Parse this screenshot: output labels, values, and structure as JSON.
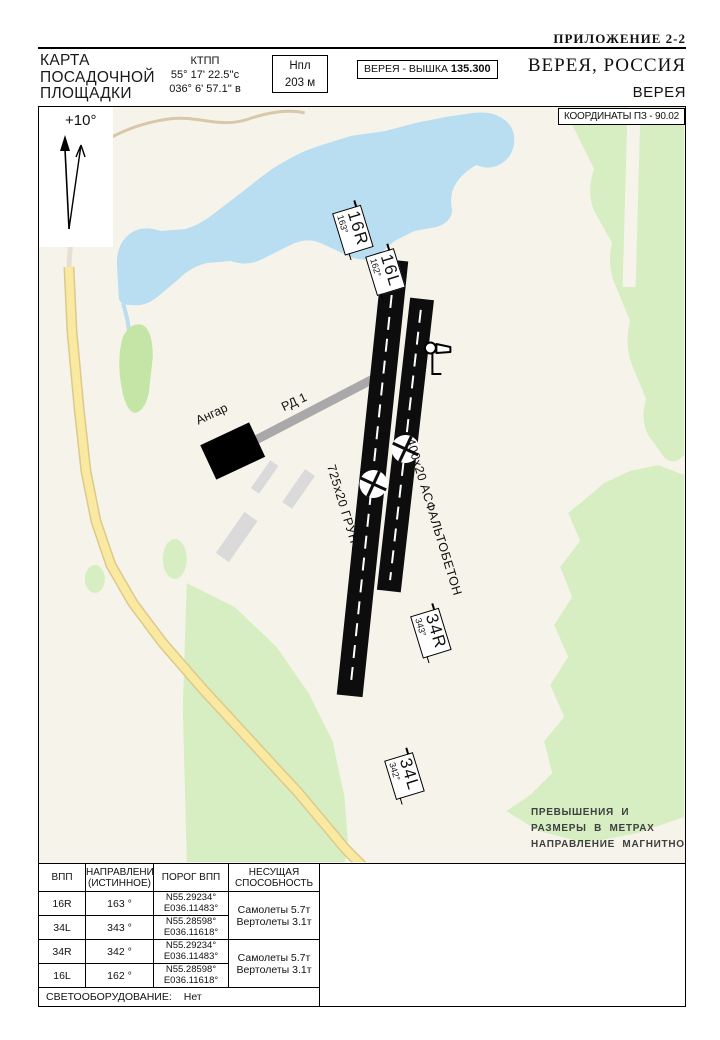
{
  "page": {
    "appendix": "ПРИЛОЖЕНИЕ  2-2",
    "title_city": "ВЕРЕЯ, РОССИЯ",
    "title_site": "ВЕРЕЯ",
    "chart_type": {
      "l1": "КАРТА",
      "l2": "ПОСАДОЧНОЙ",
      "l3": "ПЛОЩАДКИ"
    },
    "ktpp": {
      "label": "КТПП",
      "lat": "55° 17' 22.5''с",
      "lon": "036° 6' 57.1'' в"
    },
    "elevation_box": {
      "label": "Нпл",
      "value": "203 м"
    },
    "tower_box": {
      "callsign": "ВЕРЕЯ - ВЫШКА",
      "freq": "135.300"
    }
  },
  "map": {
    "coords_box": "КООРДИНАТЫ ПЗ - 90.02",
    "declination": "+10°",
    "runway_labels": [
      {
        "id": "16R",
        "hdg": "163°"
      },
      {
        "id": "16L",
        "hdg": "162°"
      },
      {
        "id": "34R",
        "hdg": "343°"
      },
      {
        "id": "34L",
        "hdg": "342°"
      }
    ],
    "surface_labels": [
      {
        "label": "725x20 ГРУНТ"
      },
      {
        "label": "400x20 АСФАЛЬТОБЕТОН"
      }
    ],
    "taxiway_label": "РД 1",
    "hangar_label": "Ангар",
    "note_lines": [
      "ПРЕВЫШЕНИЯ  И",
      "РАЗМЕРЫ  В МЕТРАХ",
      "НАПРАВЛЕНИЕ  МАГНИТНОЕ"
    ]
  },
  "table": {
    "headers": [
      {
        "l1": "ВПП",
        "l2": ""
      },
      {
        "l1": "НАПРАВЛЕНИЕ",
        "l2": "(ИСТИННОЕ)"
      },
      {
        "l1": "ПОРОГ ВПП",
        "l2": ""
      },
      {
        "l1": "НЕСУЩАЯ",
        "l2": "СПОСОБНОСТЬ"
      }
    ],
    "rows": [
      {
        "rwy": "16R",
        "true_dir": "163 °",
        "threshold": [
          "N55.29234°",
          "E036.11483°"
        ]
      },
      {
        "rwy": "34L",
        "true_dir": "343 °",
        "threshold": [
          "N55.28598°",
          "E036.11618°"
        ]
      },
      {
        "rwy": "34R",
        "true_dir": "342 °",
        "threshold": [
          "N55.29234°",
          "E036.11483°"
        ]
      },
      {
        "rwy": "16L",
        "true_dir": "162 °",
        "threshold": [
          "N55.28598°",
          "E036.11618°"
        ]
      }
    ],
    "capacity": {
      "line1": "Самолеты 5.7т",
      "line2": "Вертолеты 3.1т"
    },
    "lighting_label": "СВЕТООБОРУДОВАНИЕ:",
    "lighting_value": "Нет"
  },
  "colors": {
    "map_bg": "#f6f4ea",
    "water": "#b9ddf1",
    "forest": "#d6eec2",
    "forest_dark": "#c4e5a6",
    "road_yellow": "#f9e9a1",
    "road_casing": "#dcc98b",
    "road_tan": "#d9c7aa",
    "taxiway": "#a9a9a9",
    "runway": "#0d0d0d",
    "building": "#dadada",
    "note_text": "#3f3f3f"
  }
}
